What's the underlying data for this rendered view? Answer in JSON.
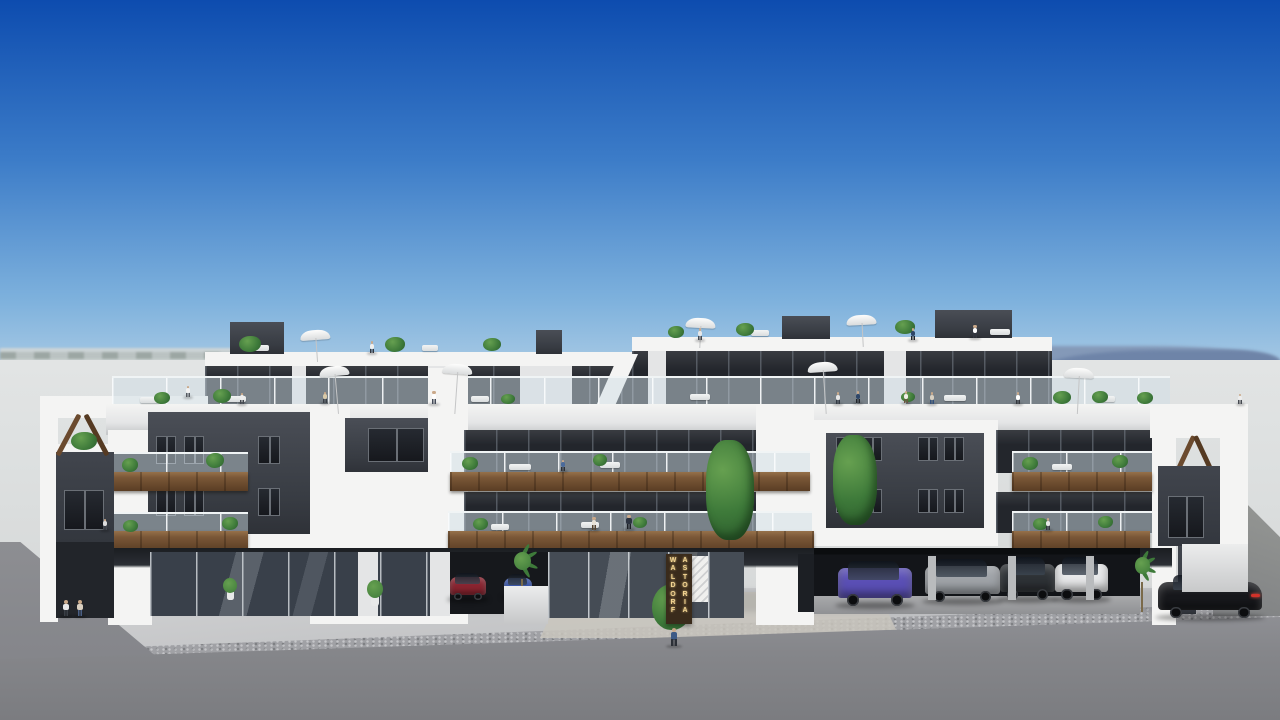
{
  "scene_type": "architectural exterior rendering of a modern three-storey apartment building with rooftop solarium, balconies and ground-floor parking under a clear blue sky",
  "sign": {
    "lines": [
      "WALDORF",
      "ASTORIA"
    ]
  },
  "palette": {
    "sky1": "#0d4caf",
    "sky2": "#3c7cc8",
    "sky3": "#7fb2dd",
    "sky4": "#c8dcea",
    "mtn1": "#6e84a8",
    "mtn2": "#8499b8",
    "hazeL": "#ccd3d6",
    "haze": "#dde0e0",
    "white1": "#f4f4f3",
    "white2": "#e4e5e6",
    "slabEdge": "#c7c9cb",
    "char0": "#2e3137",
    "char1": "#383c43",
    "char2": "#4a4e56",
    "glassDark": "#23262c",
    "mull": "#6a6f76",
    "wood1": "#7a5737",
    "wood2": "#5a3d24",
    "wood3": "#96714a",
    "railGlass": "rgba(208,222,230,0.5)",
    "green1": "#3e7a3a",
    "green2": "#66a050",
    "green3": "#2c5c2c",
    "plaza": "#c6c7c8",
    "cobble": "#a0a1a5",
    "road": "#85868a",
    "roadDark": "#7b7c80",
    "shadow": "#22252a",
    "signBg": "#3a2b1b",
    "signText": "#f2d492",
    "trav": "#c9c6bd",
    "storeGlass": "#39404a"
  },
  "scene": {
    "people": [
      {
        "x": 66,
        "y": 616,
        "h": 16,
        "shirt": "#e8e8e8",
        "pants": "#3a3f46"
      },
      {
        "x": 80,
        "y": 616,
        "h": 16,
        "shirt": "#d9cfc0",
        "pants": "#4a5f84"
      },
      {
        "x": 674,
        "y": 646,
        "h": 18,
        "shirt": "#3d5a86",
        "pants": "#2b2f36"
      },
      {
        "x": 372,
        "y": 353,
        "h": 12,
        "shirt": "#f0f0ef",
        "pants": "#333740"
      },
      {
        "x": 700,
        "y": 340,
        "h": 12,
        "shirt": "#e8e8e8",
        "pants": "#44484f"
      },
      {
        "x": 913,
        "y": 340,
        "h": 12,
        "shirt": "#2e4668",
        "pants": "#222529"
      },
      {
        "x": 975,
        "y": 338,
        "h": 13,
        "shirt": "#ffffff",
        "pants": "#333740"
      },
      {
        "x": 188,
        "y": 397,
        "h": 11,
        "shirt": "#f2f2f2",
        "pants": "#54585f"
      },
      {
        "x": 434,
        "y": 404,
        "h": 13,
        "shirt": "#ffffff",
        "pants": "#444b58"
      },
      {
        "x": 838,
        "y": 404,
        "h": 12,
        "shirt": "#e6e6e6",
        "pants": "#333a44"
      },
      {
        "x": 858,
        "y": 403,
        "h": 12,
        "shirt": "#2e4668",
        "pants": "#22262c"
      },
      {
        "x": 906,
        "y": 403,
        "h": 12,
        "shirt": "#f0eee8",
        "pants": "#6a5540"
      },
      {
        "x": 932,
        "y": 404,
        "h": 12,
        "shirt": "#d8d0c2",
        "pants": "#33507a"
      },
      {
        "x": 1018,
        "y": 404,
        "h": 12,
        "shirt": "#ffffff",
        "pants": "#33363c"
      },
      {
        "x": 242,
        "y": 404,
        "h": 11,
        "shirt": "#eeeeee",
        "pants": "#44484f"
      },
      {
        "x": 325,
        "y": 403,
        "h": 11,
        "shirt": "#d8c9a8",
        "pants": "#3a3f46"
      },
      {
        "x": 563,
        "y": 471,
        "h": 11,
        "shirt": "#4a6a9a",
        "pants": "#2b2f36"
      },
      {
        "x": 594,
        "y": 530,
        "h": 13,
        "shirt": "#e8e2d6",
        "pants": "#54432e"
      },
      {
        "x": 629,
        "y": 529,
        "h": 14,
        "shirt": "#2c3340",
        "pants": "#1d2026"
      },
      {
        "x": 1048,
        "y": 530,
        "h": 12,
        "shirt": "#e8e8e8",
        "pants": "#33363c"
      },
      {
        "x": 105,
        "y": 530,
        "h": 11,
        "shirt": "#dddddd",
        "pants": "#44484f"
      },
      {
        "x": 1240,
        "y": 404,
        "h": 10,
        "shirt": "#eeeeee",
        "pants": "#44484f"
      }
    ],
    "umbrellas": [
      {
        "x": 316,
        "y": 330,
        "pole": 24,
        "tilt": -4
      },
      {
        "x": 700,
        "y": 318,
        "pole": 22,
        "tilt": 3
      },
      {
        "x": 862,
        "y": 315,
        "pole": 24,
        "tilt": -3
      },
      {
        "x": 336,
        "y": 366,
        "pole": 40,
        "tilt": -5
      },
      {
        "x": 456,
        "y": 364,
        "pole": 42,
        "tilt": 4
      },
      {
        "x": 824,
        "y": 362,
        "pole": 44,
        "tilt": -4
      },
      {
        "x": 1078,
        "y": 368,
        "pole": 38,
        "tilt": 3
      }
    ],
    "plants": [
      {
        "x": 250,
        "y": 352,
        "w": 22,
        "h": 16,
        "kind": "bush"
      },
      {
        "x": 395,
        "y": 352,
        "w": 20,
        "h": 15,
        "kind": "bush"
      },
      {
        "x": 492,
        "y": 351,
        "w": 18,
        "h": 13,
        "kind": "bush"
      },
      {
        "x": 676,
        "y": 338,
        "w": 16,
        "h": 12,
        "kind": "bush"
      },
      {
        "x": 745,
        "y": 336,
        "w": 18,
        "h": 13,
        "kind": "bush"
      },
      {
        "x": 905,
        "y": 334,
        "w": 20,
        "h": 14,
        "kind": "bush"
      },
      {
        "x": 1062,
        "y": 404,
        "w": 18,
        "h": 13,
        "kind": "bush"
      },
      {
        "x": 1145,
        "y": 404,
        "w": 16,
        "h": 12,
        "kind": "bush"
      },
      {
        "x": 222,
        "y": 403,
        "w": 18,
        "h": 14,
        "kind": "bush"
      },
      {
        "x": 162,
        "y": 404,
        "w": 16,
        "h": 12,
        "kind": "bush"
      },
      {
        "x": 508,
        "y": 404,
        "w": 14,
        "h": 10,
        "kind": "bush"
      },
      {
        "x": 908,
        "y": 402,
        "w": 14,
        "h": 10,
        "kind": "bush"
      },
      {
        "x": 1100,
        "y": 403,
        "w": 16,
        "h": 12,
        "kind": "bush"
      },
      {
        "x": 84,
        "y": 450,
        "w": 26,
        "h": 18,
        "kind": "bush"
      },
      {
        "x": 130,
        "y": 472,
        "w": 16,
        "h": 14,
        "kind": "bush"
      },
      {
        "x": 215,
        "y": 468,
        "w": 18,
        "h": 15,
        "kind": "bush"
      },
      {
        "x": 470,
        "y": 470,
        "w": 16,
        "h": 13,
        "kind": "bush"
      },
      {
        "x": 600,
        "y": 466,
        "w": 14,
        "h": 12,
        "kind": "bush"
      },
      {
        "x": 1030,
        "y": 470,
        "w": 16,
        "h": 13,
        "kind": "bush"
      },
      {
        "x": 1120,
        "y": 468,
        "w": 16,
        "h": 13,
        "kind": "bush"
      },
      {
        "x": 130,
        "y": 532,
        "w": 15,
        "h": 12,
        "kind": "bush"
      },
      {
        "x": 230,
        "y": 530,
        "w": 16,
        "h": 13,
        "kind": "bush"
      },
      {
        "x": 480,
        "y": 530,
        "w": 15,
        "h": 12,
        "kind": "bush"
      },
      {
        "x": 640,
        "y": 528,
        "w": 14,
        "h": 11,
        "kind": "bush"
      },
      {
        "x": 1040,
        "y": 530,
        "w": 15,
        "h": 12,
        "kind": "bush"
      },
      {
        "x": 1105,
        "y": 528,
        "w": 15,
        "h": 12,
        "kind": "bush"
      },
      {
        "x": 730,
        "y": 540,
        "w": 48,
        "h": 100,
        "kind": "tree"
      },
      {
        "x": 855,
        "y": 525,
        "w": 44,
        "h": 90,
        "kind": "tree"
      },
      {
        "x": 522,
        "y": 612,
        "w": 34,
        "h": 60,
        "kind": "palm"
      },
      {
        "x": 672,
        "y": 630,
        "w": 40,
        "h": 46,
        "kind": "bush"
      },
      {
        "x": 1142,
        "y": 612,
        "w": 30,
        "h": 55,
        "kind": "palm"
      },
      {
        "x": 1205,
        "y": 596,
        "w": 26,
        "h": 40,
        "kind": "palm"
      },
      {
        "x": 375,
        "y": 606,
        "w": 16,
        "h": 26,
        "kind": "pot"
      },
      {
        "x": 230,
        "y": 600,
        "w": 14,
        "h": 22,
        "kind": "pot"
      },
      {
        "x": 1172,
        "y": 606,
        "w": 12,
        "h": 24,
        "kind": "pot"
      }
    ],
    "furniture": [
      {
        "x": 260,
        "y": 351,
        "w": 18
      },
      {
        "x": 430,
        "y": 351,
        "w": 16
      },
      {
        "x": 760,
        "y": 336,
        "w": 18
      },
      {
        "x": 1000,
        "y": 335,
        "w": 20
      },
      {
        "x": 150,
        "y": 403,
        "w": 20
      },
      {
        "x": 235,
        "y": 402,
        "w": 22
      },
      {
        "x": 480,
        "y": 402,
        "w": 18
      },
      {
        "x": 700,
        "y": 400,
        "w": 20
      },
      {
        "x": 955,
        "y": 401,
        "w": 22
      },
      {
        "x": 1105,
        "y": 402,
        "w": 20
      },
      {
        "x": 520,
        "y": 470,
        "w": 22
      },
      {
        "x": 610,
        "y": 468,
        "w": 20
      },
      {
        "x": 1062,
        "y": 470,
        "w": 20
      },
      {
        "x": 500,
        "y": 530,
        "w": 18
      },
      {
        "x": 590,
        "y": 528,
        "w": 18
      }
    ],
    "cars": [
      {
        "x": 450,
        "y": 572,
        "w": 36,
        "h": 28,
        "color": "#8a2430",
        "kind": "suv"
      },
      {
        "x": 504,
        "y": 574,
        "w": 28,
        "h": 24,
        "color": "#3a56a8",
        "kind": "suv"
      },
      {
        "x": 838,
        "y": 560,
        "w": 74,
        "h": 46,
        "color": "#5a4fb5",
        "kind": "suv"
      },
      {
        "x": 925,
        "y": 558,
        "w": 75,
        "h": 44,
        "color": "#9fa3a8",
        "kind": "wagon"
      },
      {
        "x": 1000,
        "y": 556,
        "w": 55,
        "h": 44,
        "color": "#2e3236",
        "kind": "suv"
      },
      {
        "x": 1055,
        "y": 556,
        "w": 53,
        "h": 44,
        "color": "#e8e9ea",
        "kind": "suv"
      },
      {
        "x": 1158,
        "y": 574,
        "w": 104,
        "h": 44,
        "color": "#17181c",
        "kind": "coupe"
      }
    ]
  }
}
